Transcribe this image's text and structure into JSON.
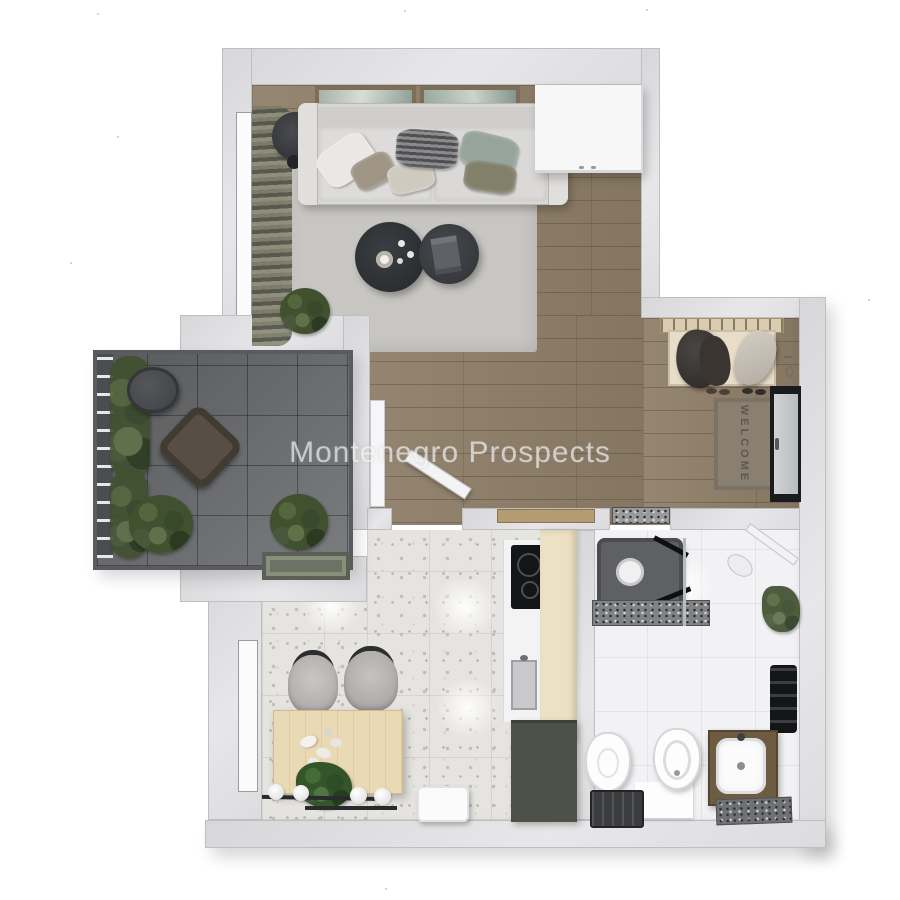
{
  "watermark": {
    "text": "Montenegro Prospects",
    "color": "rgba(255,255,255,0.62)"
  },
  "entry": {
    "welcome_mat_text": "WELCOME"
  },
  "palette": {
    "background": "#ffffff",
    "wall": "#dfdfe1",
    "wood_floor": "#8d7d67",
    "balcony_tile": "#6b6d70",
    "terrazzo_floor": "#e6e4e0",
    "bathroom_tile": "#f2f2f4",
    "living_rug": "#c7c6c2",
    "sofa": "#d8d7d5",
    "coffee_table": "#33363a",
    "dining_table": "#ead9b5",
    "cream_cabinet": "#ece0c5",
    "dark_counter": "#4c5248",
    "welcome_mat": "#8a8071",
    "front_door_recess": "#1a1b1d"
  }
}
